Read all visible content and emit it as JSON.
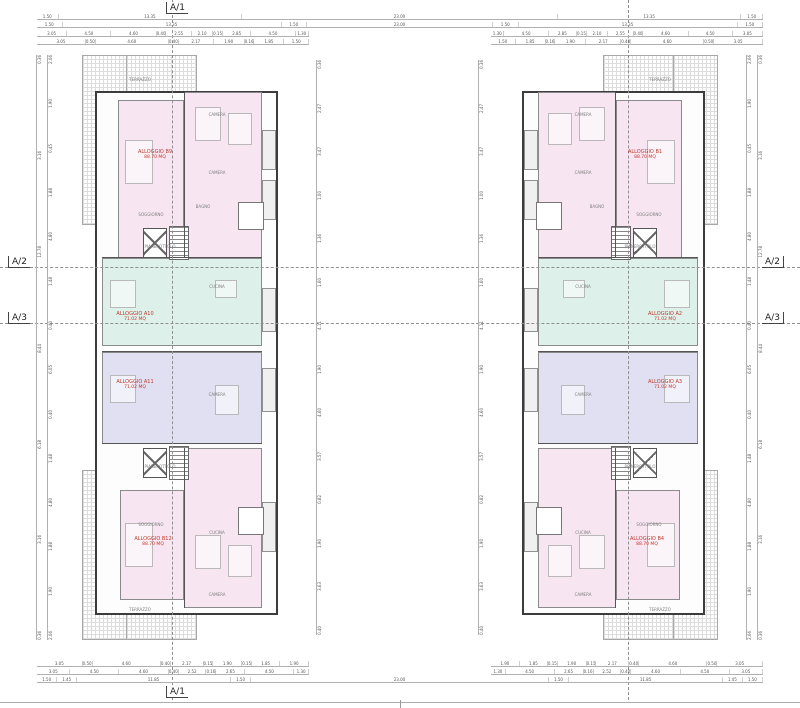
{
  "axes": {
    "a1": "A/1",
    "a2": "A/2",
    "a3": "A/3"
  },
  "colors": {
    "apartment_pink": "#f7e6f2",
    "apartment_teal": "#ddf0ea",
    "apartment_blue": "#e0e0f2",
    "label_red": "#c0392b",
    "wall_gray": "#3c3c3c",
    "dimension_gray": "#555555"
  },
  "apartments": {
    "left": [
      {
        "name": "ALLOGGIO B9",
        "area": "88.70 MQ"
      },
      {
        "name": "ALLOGGIO A10",
        "area": "71.02 MQ"
      },
      {
        "name": "ALLOGGIO A11",
        "area": "71.02 MQ"
      },
      {
        "name": "ALLOGGIO B12",
        "area": "88.70 MQ"
      }
    ],
    "right": [
      {
        "name": "ALLOGGIO B1",
        "area": "88.70 MQ"
      },
      {
        "name": "ALLOGGIO A2",
        "area": "71.02 MQ"
      },
      {
        "name": "ALLOGGIO A3",
        "area": "71.02 MQ"
      },
      {
        "name": "ALLOGGIO B4",
        "area": "88.70 MQ"
      }
    ]
  },
  "room_labels": [
    "TERRAZZO",
    "CAMERA",
    "CAMERA",
    "BAGNO",
    "SOGGIORNO",
    "PIANEROTTOLO",
    "CUCINA",
    "CAMERA",
    "PIANEROTTOLO",
    "SOGGIORNO",
    "CUCINA",
    "CAMERA",
    "TERRAZZO"
  ],
  "dimensions": {
    "top_full": [
      1.5,
      13.35,
      23.0,
      13.35,
      1.5
    ],
    "top_building": [
      1.5,
      13.35,
      1.5
    ],
    "gap": [
      23.0
    ],
    "top_detail_a": [
      3.05,
      4.5,
      4.6,
      0.4,
      2.55,
      2.1,
      0.15,
      2.85,
      4.5,
      1.3
    ],
    "top_detail_b": [
      3.05,
      0.5,
      4.6,
      0.4,
      2.17,
      1.9,
      0.16,
      1.85,
      1.5
    ],
    "bottom_detail_a": [
      3.05,
      0.5,
      4.6,
      0.4,
      2.17,
      0.15,
      1.9,
      0.15,
      1.85,
      1.9
    ],
    "bottom_detail_b": [
      3.05,
      4.5,
      4.6,
      0.4,
      2.52,
      0.16,
      2.65,
      4.5,
      1.3
    ],
    "bottom_full": [
      1.5,
      1.45,
      11.85,
      1.5,
      23.0,
      1.5,
      11.85,
      1.45,
      1.5
    ],
    "side_outer": [
      0.36,
      3.16,
      12.78,
      8.44,
      6.18,
      3.16,
      0.36
    ],
    "side_inner": [
      2.06,
      1.9,
      0.45,
      1.88,
      4.8,
      1.48,
      0.4,
      6.05,
      0.4,
      1.48,
      4.8,
      1.88,
      1.9,
      2.06
    ],
    "court_col": [
      0.36,
      2.47,
      3.47,
      1.0,
      1.36,
      1.6,
      4.11,
      1.9,
      4.6,
      3.57,
      0.82,
      1.9,
      3.63,
      0.4
    ]
  }
}
